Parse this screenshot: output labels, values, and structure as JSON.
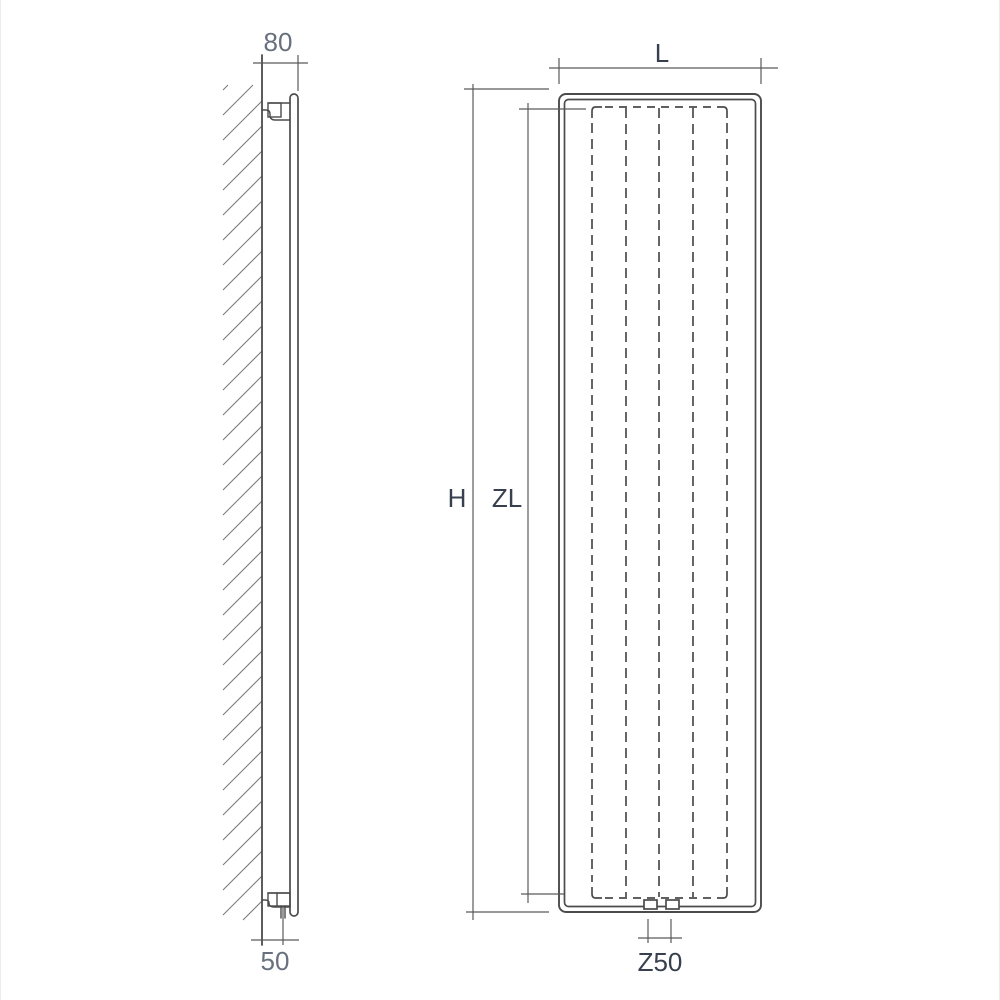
{
  "colors": {
    "line": "#4b4b4b",
    "dimension_line": "#5a5a5a",
    "hatch_line": "#787878",
    "text_primary": "#38404f",
    "text_secondary": "#68707e",
    "background": "#ffffff"
  },
  "side_view": {
    "depth_label": "80",
    "pipe_offset_label": "50"
  },
  "front_view": {
    "width_label": "L",
    "height_label": "H",
    "element_height_label": "ZL",
    "connection_spacing_label": "Z50"
  }
}
